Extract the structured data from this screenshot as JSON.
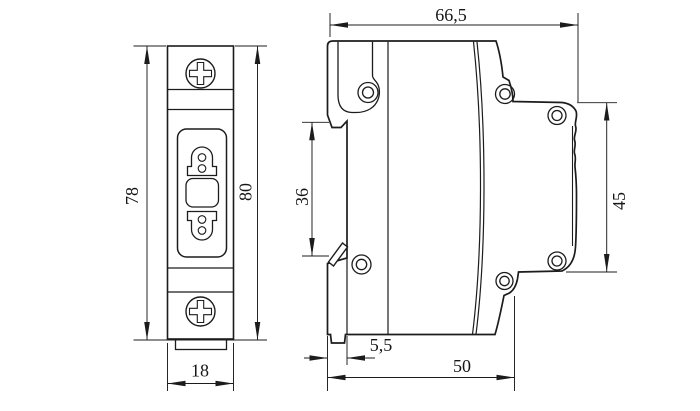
{
  "drawing": {
    "background_color": "#ffffff",
    "line_color": "#1c1c1c",
    "dimensions": {
      "overall_depth": "66,5",
      "height_outer": "78",
      "height_inner": "80",
      "rail_recess": "36",
      "terminal_face": "45",
      "module_width": "18",
      "rail_step": "5,5",
      "body_depth": "50"
    }
  }
}
